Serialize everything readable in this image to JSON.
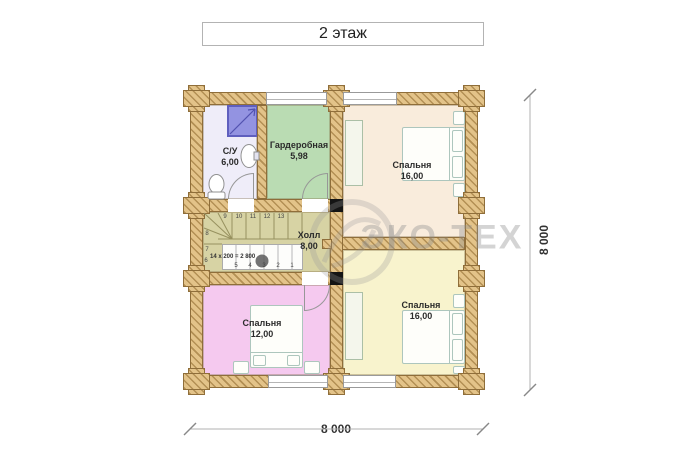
{
  "title": "2 этаж",
  "watermark": {
    "text": "ЭКО-ТЕХ"
  },
  "dimensions": {
    "width_label": "8 000",
    "height_label": "8 000"
  },
  "rooms": {
    "bathroom": {
      "name": "С/У",
      "area": "6,00"
    },
    "wardrobe": {
      "name": "Гардеробная",
      "area": "5,98"
    },
    "bedroom_top": {
      "name": "Спальня",
      "area": "16,00"
    },
    "hall": {
      "name": "Холл",
      "area": "8,00"
    },
    "bedroom_left": {
      "name": "Спальня",
      "area": "12,00"
    },
    "bedroom_bottom": {
      "name": "Спальня",
      "area": "16,00"
    }
  },
  "stairs": {
    "annotation": "14 x 200 = 2 800",
    "upper_numbers": [
      "9",
      "10",
      "11",
      "12",
      "13"
    ],
    "side_numbers": [
      "8",
      "7",
      "6"
    ],
    "lower_numbers": [
      "5",
      "4",
      "3",
      "2",
      "1"
    ]
  },
  "colors": {
    "wall": "#e3c389",
    "bathroom_floor": "#efedf9",
    "wardrobe_floor": "#badcb3",
    "bedroom_cream": "#f9ecdc",
    "bedroom_yellow": "#f8f3cd",
    "bedroom_pink": "#f5c9ef",
    "hall_floor": "#d7d3a4",
    "shower": "#9393e1"
  }
}
